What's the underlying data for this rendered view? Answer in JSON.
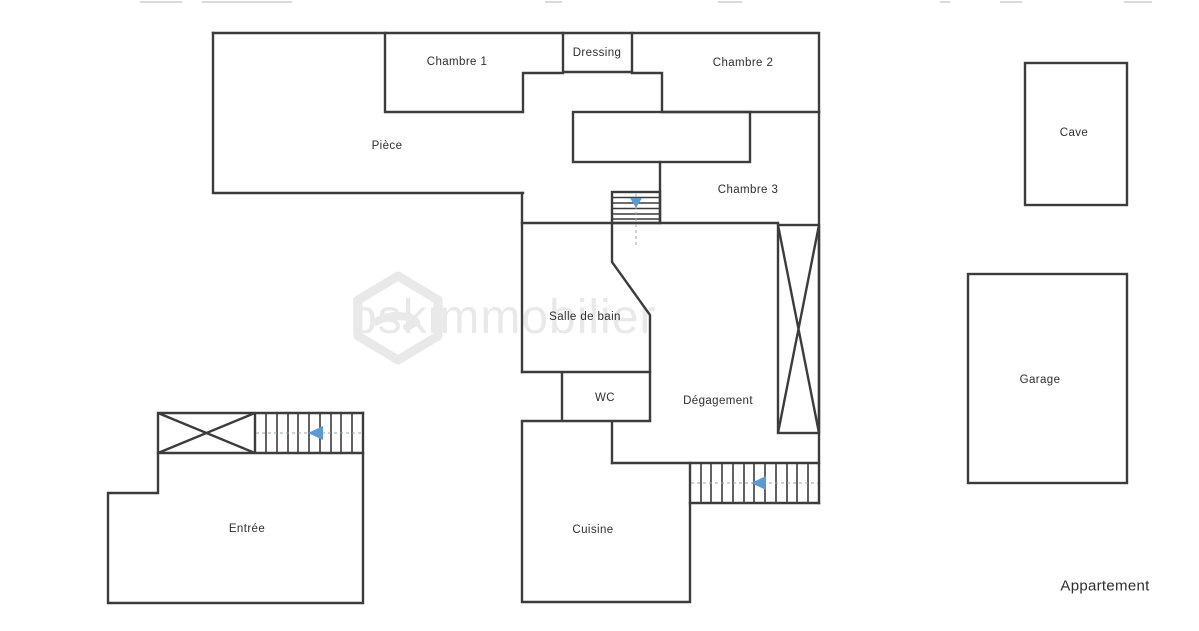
{
  "document_title": "Plan d'appartement",
  "colors": {
    "wall": "#3c3c3c",
    "label": "#2e2e2e",
    "arrow": "#5b9bd5",
    "dash": "#9aa4ad",
    "watermark": "#e9e9e9",
    "artifact": "#d9d9d9"
  },
  "rooms": {
    "piece": "Pièce",
    "chambre1": "Chambre 1",
    "dressing": "Dressing",
    "chambre2": "Chambre 2",
    "chambre3": "Chambre 3",
    "salle_de_bain": "Salle de bain",
    "wc": "WC",
    "degagement": "Dégagement",
    "cuisine": "Cuisine",
    "entree": "Entrée"
  },
  "annexes": {
    "cave": "Cave",
    "garage": "Garage"
  },
  "caption": "Appartement",
  "watermark": {
    "brand": "bskimmobilier",
    "logo": "hexagon-house-logo"
  }
}
